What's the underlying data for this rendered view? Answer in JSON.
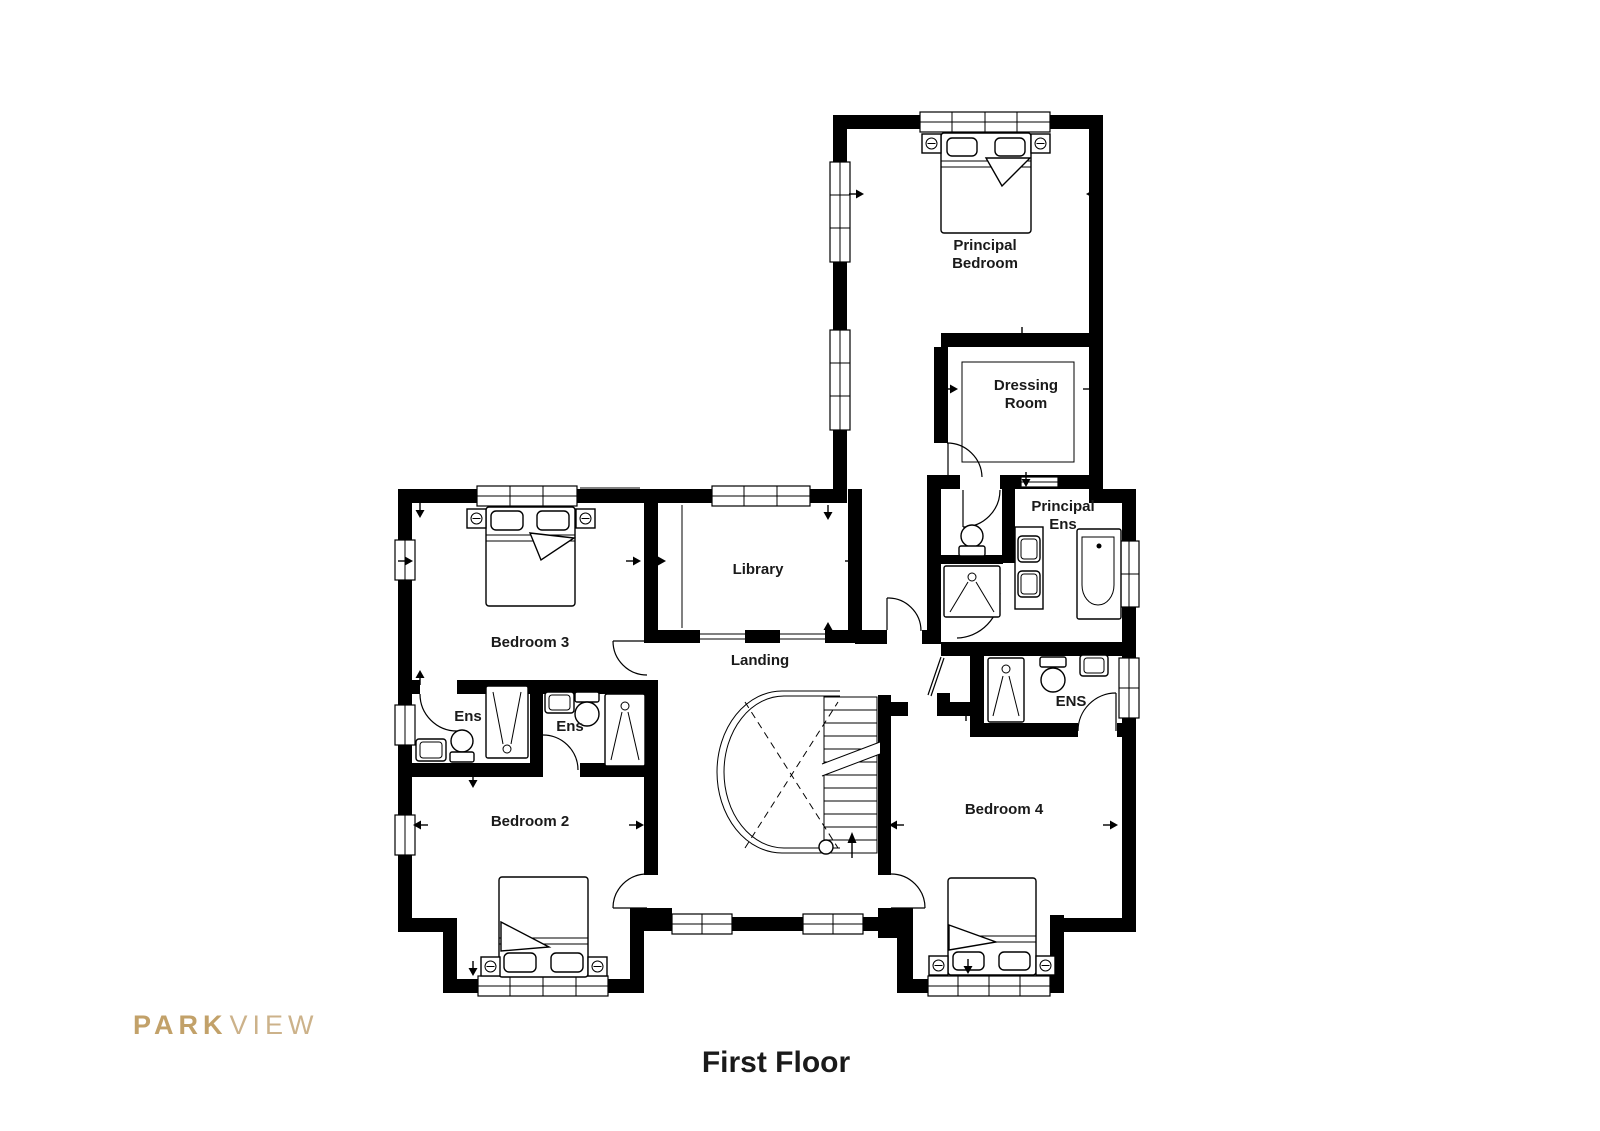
{
  "floor_title": "First Floor",
  "brand": {
    "bold": "PARK",
    "light": "VIEW"
  },
  "rooms": {
    "principal_bedroom": {
      "line1": "Principal",
      "line2": "Bedroom"
    },
    "dressing_room": {
      "line1": "Dressing",
      "line2": "Room"
    },
    "principal_ens": {
      "line1": "Principal",
      "line2": "Ens"
    },
    "library": {
      "label": "Library"
    },
    "landing": {
      "label": "Landing"
    },
    "bedroom3": {
      "label": "Bedroom 3"
    },
    "ens_bedroom3": {
      "label": "Ens"
    },
    "ens_bedroom2": {
      "label": "Ens"
    },
    "bedroom2": {
      "label": "Bedroom 2"
    },
    "ens_bedroom4": {
      "label": "ENS"
    },
    "bedroom4": {
      "label": "Bedroom 4"
    }
  },
  "colors": {
    "wall": "#000000",
    "background": "#ffffff",
    "text": "#1a1a1a",
    "brand_gold": "#c2a169",
    "brand_gold_light": "#ccb28a"
  }
}
